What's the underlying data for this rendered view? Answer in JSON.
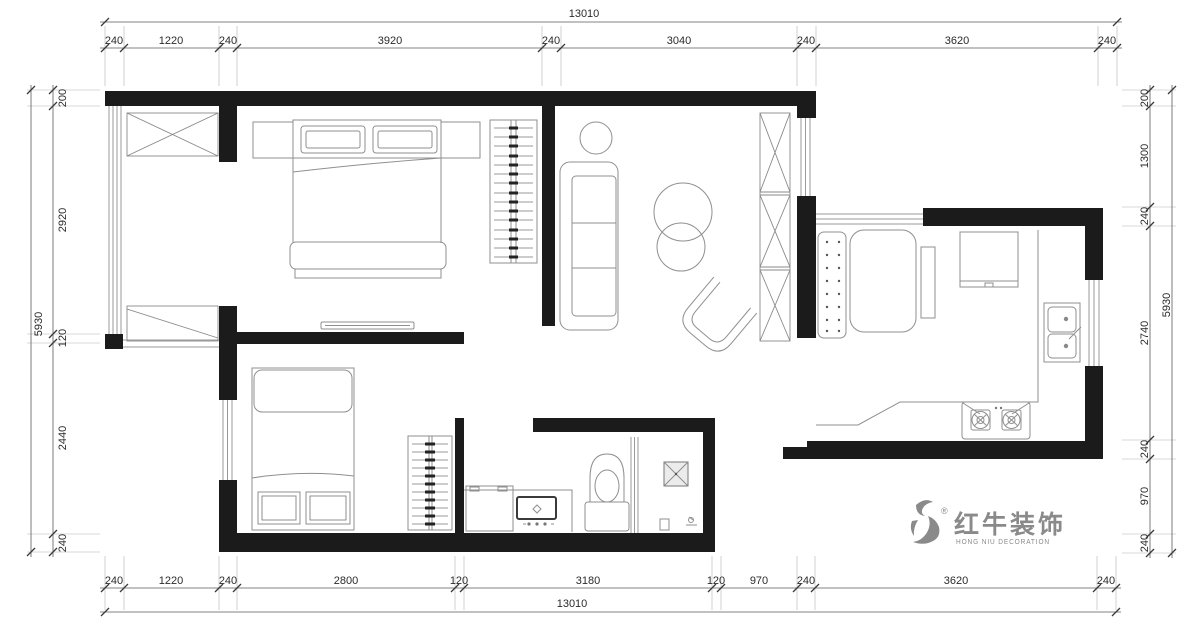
{
  "dimensions": {
    "top": {
      "total": "13010",
      "segments": [
        "240",
        "1220",
        "240",
        "3920",
        "240",
        "3040",
        "240",
        "3620",
        "240"
      ]
    },
    "bottom": {
      "total": "13010",
      "segments": [
        "240",
        "1220",
        "240",
        "2800",
        "120",
        "3180",
        "120",
        "970",
        "240",
        "3620",
        "240"
      ]
    },
    "left": {
      "total": "5930",
      "segments": [
        "200",
        "2920",
        "120",
        "2440",
        "240"
      ]
    },
    "right": {
      "total": "5930",
      "segments": [
        "200",
        "1300",
        "240",
        "2740",
        "240",
        "970",
        "240"
      ]
    }
  },
  "logo": {
    "registered": "®",
    "brand_cn": "红牛装饰",
    "brand_en": "HONG NIU DECORATION",
    "color": "#8a8a8a"
  },
  "colors": {
    "walls": "#1b1b1b",
    "furniture": "#8f8f8f",
    "dimension_text": "#2b2b2b",
    "background": "#ffffff"
  }
}
